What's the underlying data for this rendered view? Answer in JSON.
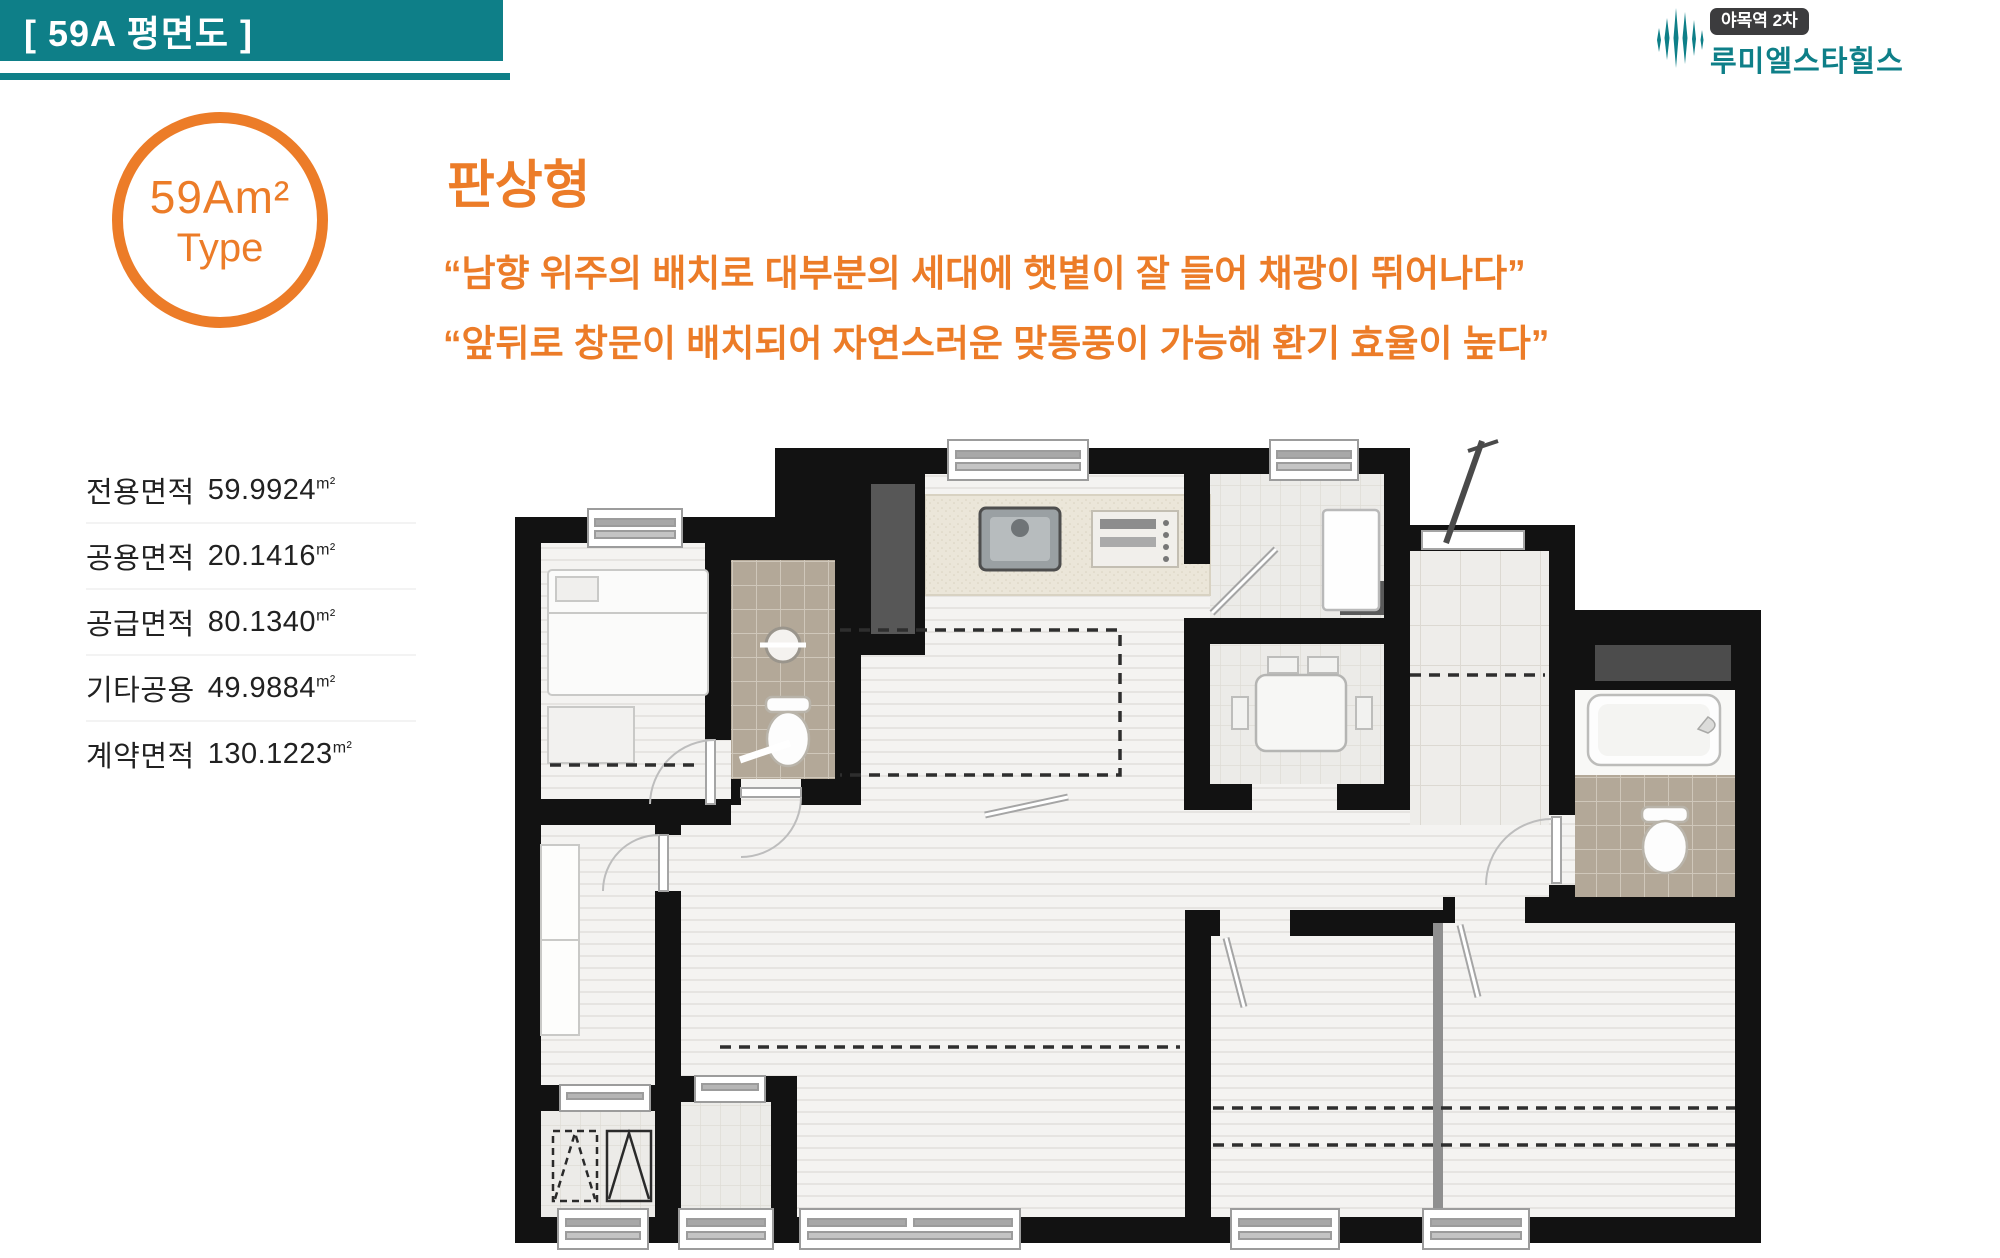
{
  "header": {
    "title": "[ 59A 평면도 ]"
  },
  "logo": {
    "badge": "야목역 2차",
    "name": "루미엘스타힐스"
  },
  "unit_badge": {
    "line1": "59Am²",
    "line2": "Type"
  },
  "intro": {
    "type_title": "판상형",
    "quote1": "“남향 위주의 배치로 대부분의 세대에 햇볕이 잘 들어 채광이 뛰어나다”",
    "quote2": "“앞뒤로 창문이 배치되어 자연스러운 맞통풍이 가능해 환기 효율이 높다”"
  },
  "areas": [
    {
      "label": "전용면적",
      "value": "59.9924",
      "unit": "m²"
    },
    {
      "label": "공용면적",
      "value": "20.1416",
      "unit": "m²"
    },
    {
      "label": "공급면적",
      "value": "80.1340",
      "unit": "m²"
    },
    {
      "label": "기타공용",
      "value": "49.9884",
      "unit": "m²"
    },
    {
      "label": "계약면적",
      "value": "130.1223",
      "unit": "m²"
    }
  ],
  "colors": {
    "teal": "#0e7f88",
    "orange": "#ec7c28",
    "wall": "#121212",
    "bath_tile": "#b9ae9e",
    "shaft_gray": "#565656"
  },
  "plan": {
    "kind": "apartment-floor-plan",
    "unit_type": "59A"
  }
}
